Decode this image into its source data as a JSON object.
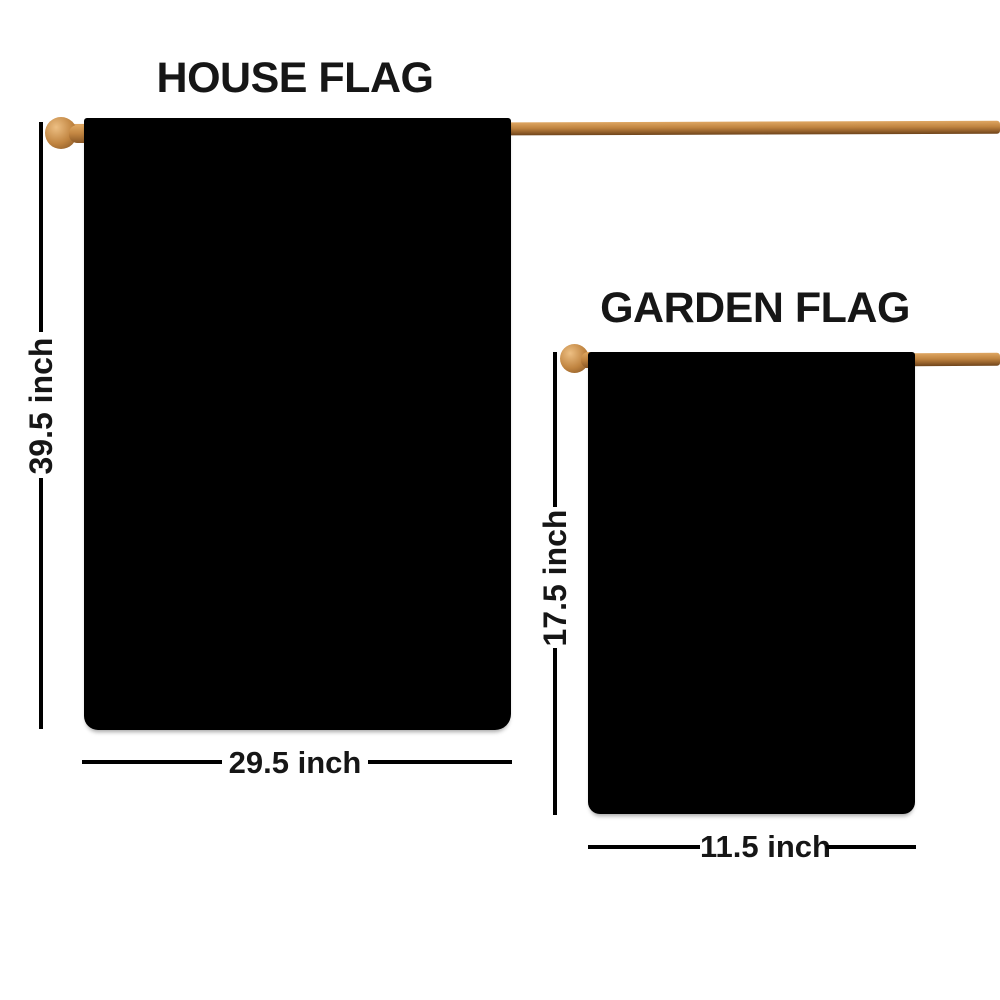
{
  "house": {
    "title": "HOUSE FLAG",
    "height_label": "39.5 inch",
    "width_label": "29.5 inch"
  },
  "garden": {
    "title": "GARDEN FLAG",
    "height_label": "17.5 inch",
    "width_label": "11.5 inch"
  },
  "colors": {
    "background": "#ffffff",
    "flag": "#000000",
    "text": "#161616",
    "dimension_line": "#000000",
    "pole": "#c08440",
    "pole_highlight": "#dfa763",
    "pole_shadow": "#6e441b"
  }
}
